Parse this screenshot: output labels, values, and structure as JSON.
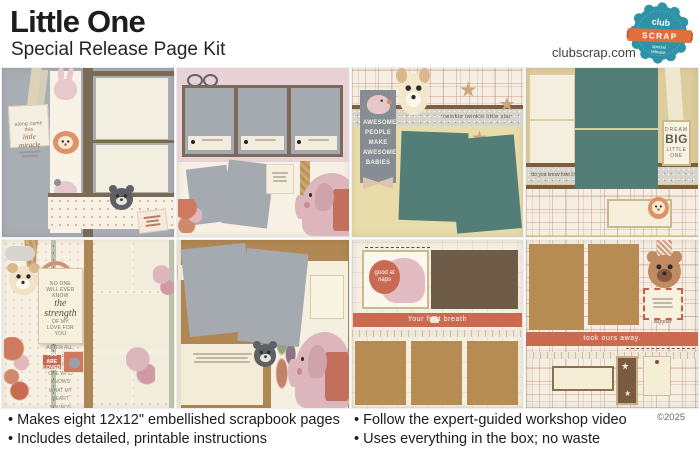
{
  "header": {
    "title": "Little One",
    "subtitle": "Special Release Page Kit",
    "website": "clubscrap.com",
    "badge": {
      "name_top": "club",
      "name_main": "SCRAP",
      "sub1": "special",
      "sub2": "release"
    }
  },
  "footer": {
    "bullets_left": [
      "Makes eight 12x12\" embellished scrapbook pages",
      "Includes detailed, printable instructions"
    ],
    "bullets_right": [
      "Follow the expert-guided workshop video",
      "Uses everything in the box; no waste"
    ],
    "copyright": "©2025"
  },
  "pages": [
    {
      "tag_line1": "along came this",
      "tag_line2": "little miracle"
    },
    {},
    {
      "banner": "Awesome people make awesome babies",
      "strip": "twinkle twinkle little star"
    },
    {
      "strip": "do you know how LOVED you are?",
      "tag_top": "DREAM",
      "tag_main": "BIG",
      "tag_sub": "LITTLE ONE"
    },
    {
      "quote_line1": "NO ONE WILL EVER KNOW",
      "quote_line2": "the strength",
      "quote_line3": "OF MY LOVE FOR YOU",
      "quote_body": "After all, you are the only one who knows what my heart sounds like from the inside",
      "label": "You are loved"
    },
    {},
    {
      "sticker": "good at naps",
      "banner": "Your first breath"
    },
    {
      "banner": "took ours away.",
      "word": "happier"
    }
  ],
  "colors": {
    "ink": "#1e1c1c",
    "badge_teal": "#2e93a7",
    "badge_orange": "#e0703a",
    "photo_teal": "#537e78",
    "caramel": "#b78c52",
    "coral_banner": "#cc6a50",
    "blush_pink": "#e9d2d5",
    "page_gray": "#a9adb4",
    "cream": "#f4eede",
    "frame_brown": "#7b6a55"
  }
}
